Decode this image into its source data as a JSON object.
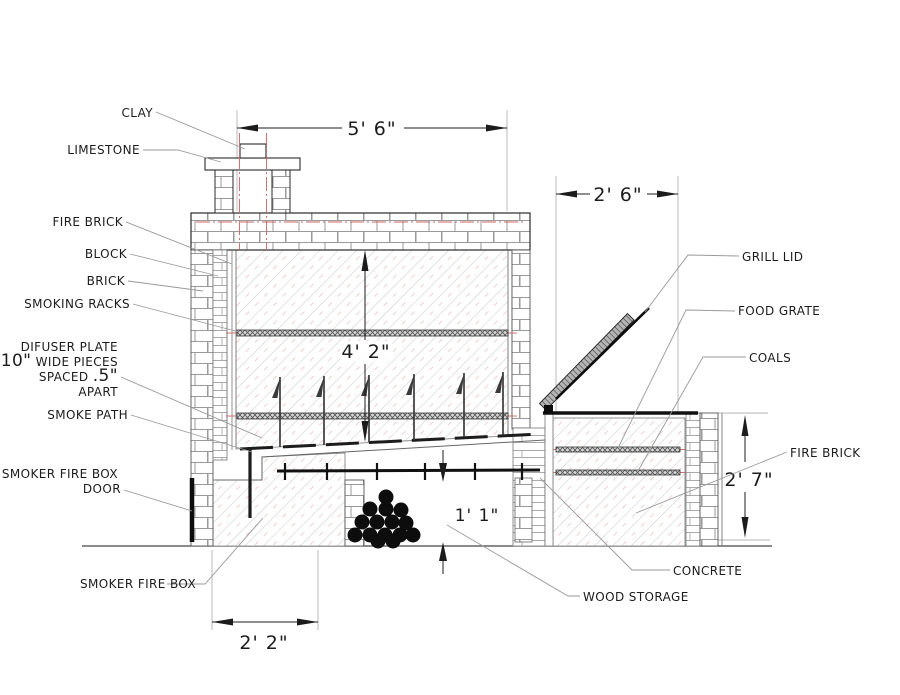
{
  "title": "Smoker and grill construction section drawing",
  "labels": {
    "clay": "CLAY",
    "limestone": "LIMESTONE",
    "fire_brick_left": "FIRE BRICK",
    "block": "BLOCK",
    "brick": "BRICK",
    "smoking_racks": "SMOKING RACKS",
    "difuser_plate_line1": "DIFUSER PLATE",
    "difuser_plate_size1": "10\"",
    "difuser_plate_line2": " WIDE PIECES",
    "difuser_plate_line3a": "SPACED ",
    "difuser_plate_size2": ".5\"",
    "difuser_plate_line4": "APART",
    "smoke_path": "SMOKE PATH",
    "smoker_fire_box_door_line1": "SMOKER FIRE BOX",
    "smoker_fire_box_door_line2": "DOOR",
    "smoker_fire_box": "SMOKER FIRE BOX",
    "wood_storage": "WOOD STORAGE",
    "concrete": "CONCRETE",
    "fire_brick_right": "FIRE BRICK",
    "coals": "COALS",
    "food_grate": "FOOD GRATE",
    "grill_lid": "GRILL LID"
  },
  "dimensions": {
    "smoker_inner_width": "5' 6\"",
    "grill_width": "2' 6\"",
    "chamber_height": "4' 2\"",
    "grill_height": "2' 7\"",
    "wood_storage_height": "1' 1\"",
    "firebox_width": "2' 2\""
  },
  "colors": {
    "line": "#1c1c1c",
    "leader": "#9a9a9a",
    "extension": "#b4b4b4",
    "centerline_red": "#cc6363",
    "hatch": "#c9c9c9",
    "mortar": "#9a9a9a"
  }
}
